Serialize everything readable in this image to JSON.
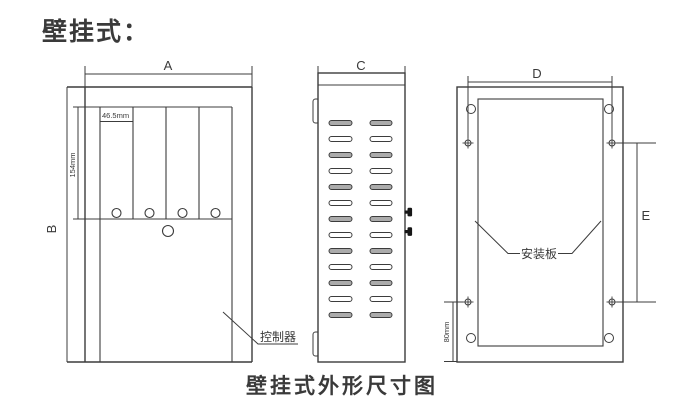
{
  "title": "壁挂式：",
  "caption": "壁挂式外形尺寸图",
  "colors": {
    "line": "#3c3c3c",
    "text": "#3a3a3a",
    "vent_fill": "#ababab",
    "knob": "#161616",
    "background": "#ffffff"
  },
  "views": {
    "front": {
      "dim_width_label": "A",
      "dim_height_label": "B",
      "slot_width_label": "46.5mm",
      "slot_height_label": "154mm",
      "part_label": "控制器",
      "slot_count": 4
    },
    "side": {
      "dim_width_label": "C",
      "vent_rows": 13,
      "vent_cols": 2,
      "knob_count": 2
    },
    "back": {
      "dim_width_label": "D",
      "dim_height_label": "E",
      "bottom_offset_label": "80mm",
      "part_label": "安装板",
      "screw_count": 4,
      "corner_hole_count": 4
    }
  }
}
